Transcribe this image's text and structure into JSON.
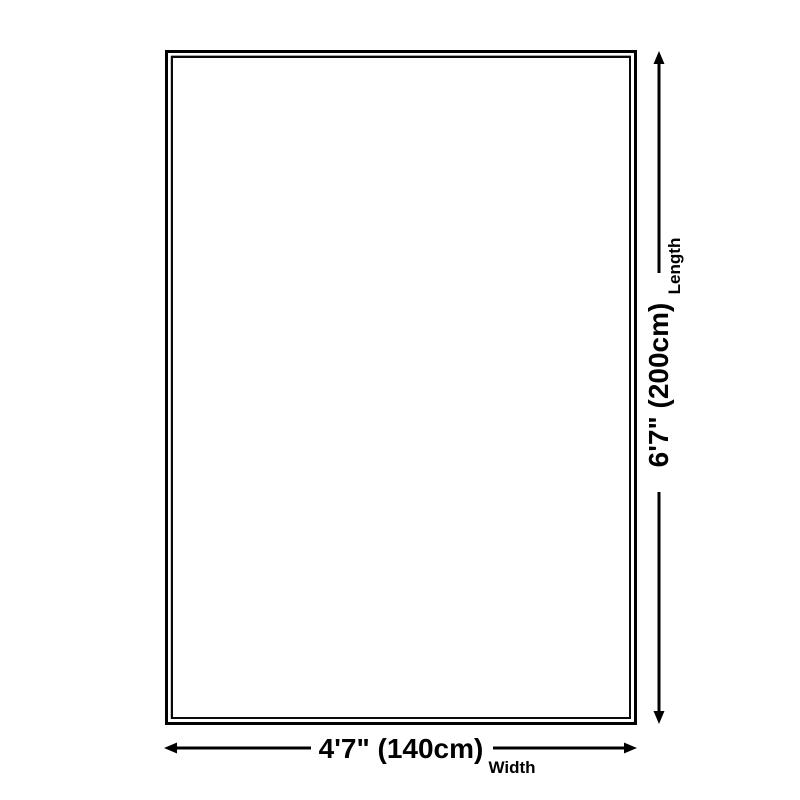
{
  "page": {
    "background_color": "#ffffff",
    "line_color": "#000000"
  },
  "diagram": {
    "type": "product-size-diagram",
    "rug": {
      "border_color": "#000000",
      "fill": "#ffffff"
    },
    "length_dimension": {
      "value": "6'7\" (200cm)",
      "label": "Length"
    },
    "width_dimension": {
      "value": "4'7\" (140cm)",
      "label": "Width"
    }
  }
}
